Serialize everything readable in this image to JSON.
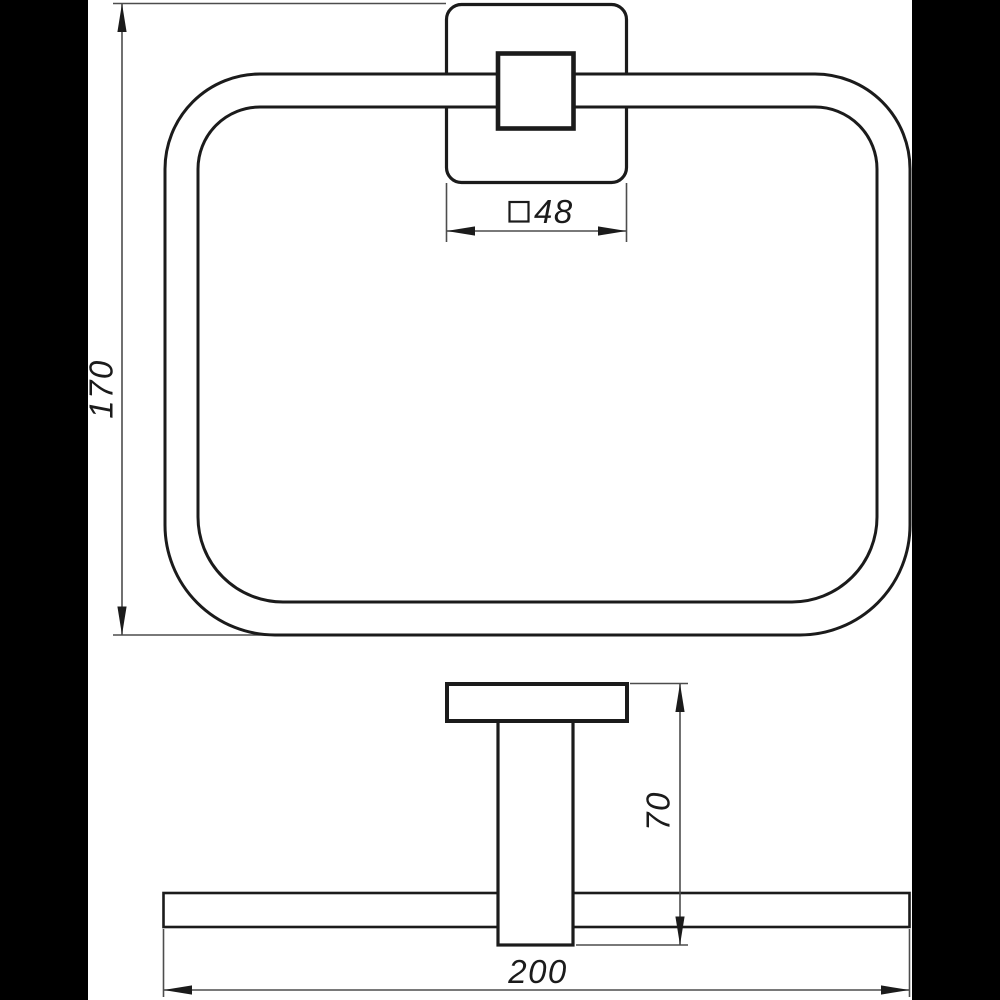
{
  "drawing": {
    "title": "towel-ring-technical-drawing",
    "views": {
      "front": "front-view-of-square-towel-ring",
      "side": "side-profile-view"
    },
    "dimensions": {
      "overall_height": {
        "label": "170"
      },
      "plate_size": {
        "symbol": "□",
        "label": "48"
      },
      "depth": {
        "label": "70"
      },
      "overall_width": {
        "label": "200"
      }
    },
    "colors": {
      "outline": "#1b1b1b",
      "dimension_line": "#4d4d4d",
      "canvas": "#ffffff",
      "pillarbox": "#000000"
    }
  }
}
